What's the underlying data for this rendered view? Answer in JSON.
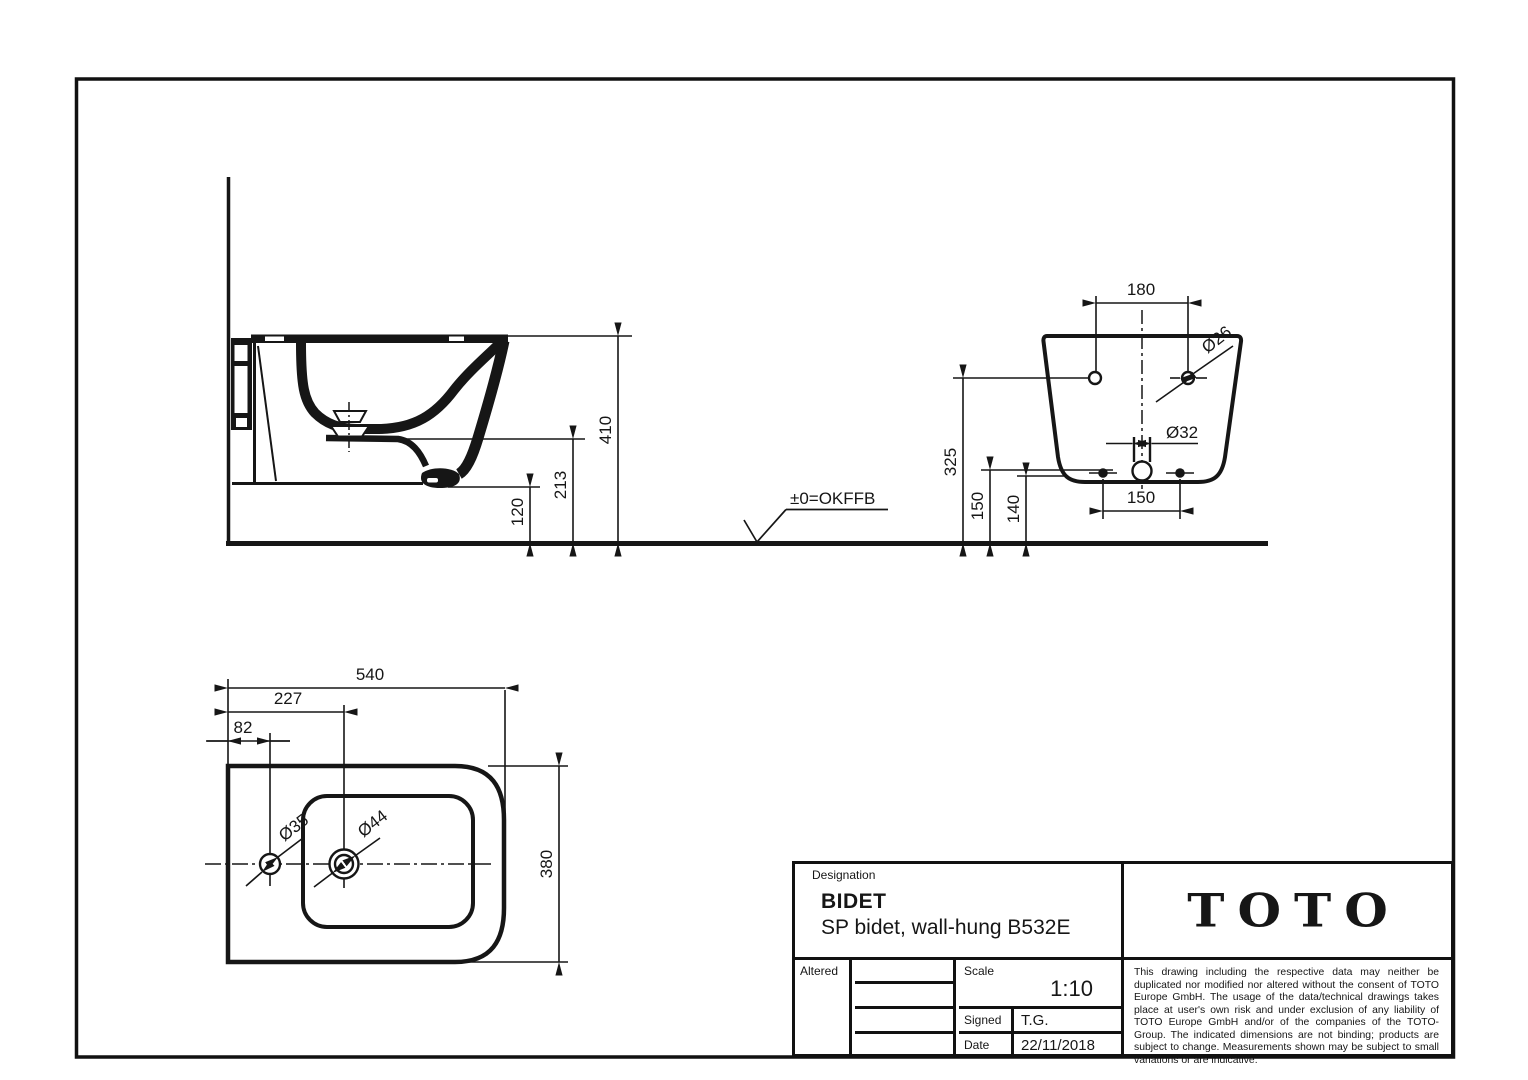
{
  "title_block": {
    "designation_label": "Designation",
    "product_title": "BIDET",
    "product_subtitle": "SP bidet, wall-hung B532E",
    "brand_logo": "TOTO",
    "altered_label": "Altered",
    "scale_label": "Scale",
    "scale_value": "1:10",
    "signed_label": "Signed",
    "signed_value": "T.G.",
    "date_label": "Date",
    "date_value": "22/11/2018",
    "disclaimer": "This drawing including the respective data may neither be duplicated nor modified nor altered without the consent of TOTO Europe GmbH. The usage of the data/technical drawings takes place at user's own risk and under exclusion of any liability of TOTO Europe GmbH and/or of the companies of the TOTO-Group. The indicated dimensions are not binding; products are subject to change. Measurements shown may be subject to small variations or are indicative."
  },
  "datum_label": "±0=OKFFB",
  "dimensions": {
    "side_view": {
      "overall_height": "410",
      "mid_height": "213",
      "underside_height": "120"
    },
    "rear_view": {
      "mount_hole_spacing": "180",
      "mount_hole_dia": "Ø26",
      "outlet_dia": "Ø32",
      "mount_height": "325",
      "fix_height": "150",
      "outlet_height": "140",
      "fix_spacing": "150"
    },
    "top_view": {
      "length": "540",
      "drain_offset": "227",
      "tap_offset": "82",
      "tap_dia": "Ø35",
      "drain_dia": "Ø44",
      "width": "380"
    }
  },
  "colors": {
    "line": "#161616",
    "background": "#ffffff"
  }
}
